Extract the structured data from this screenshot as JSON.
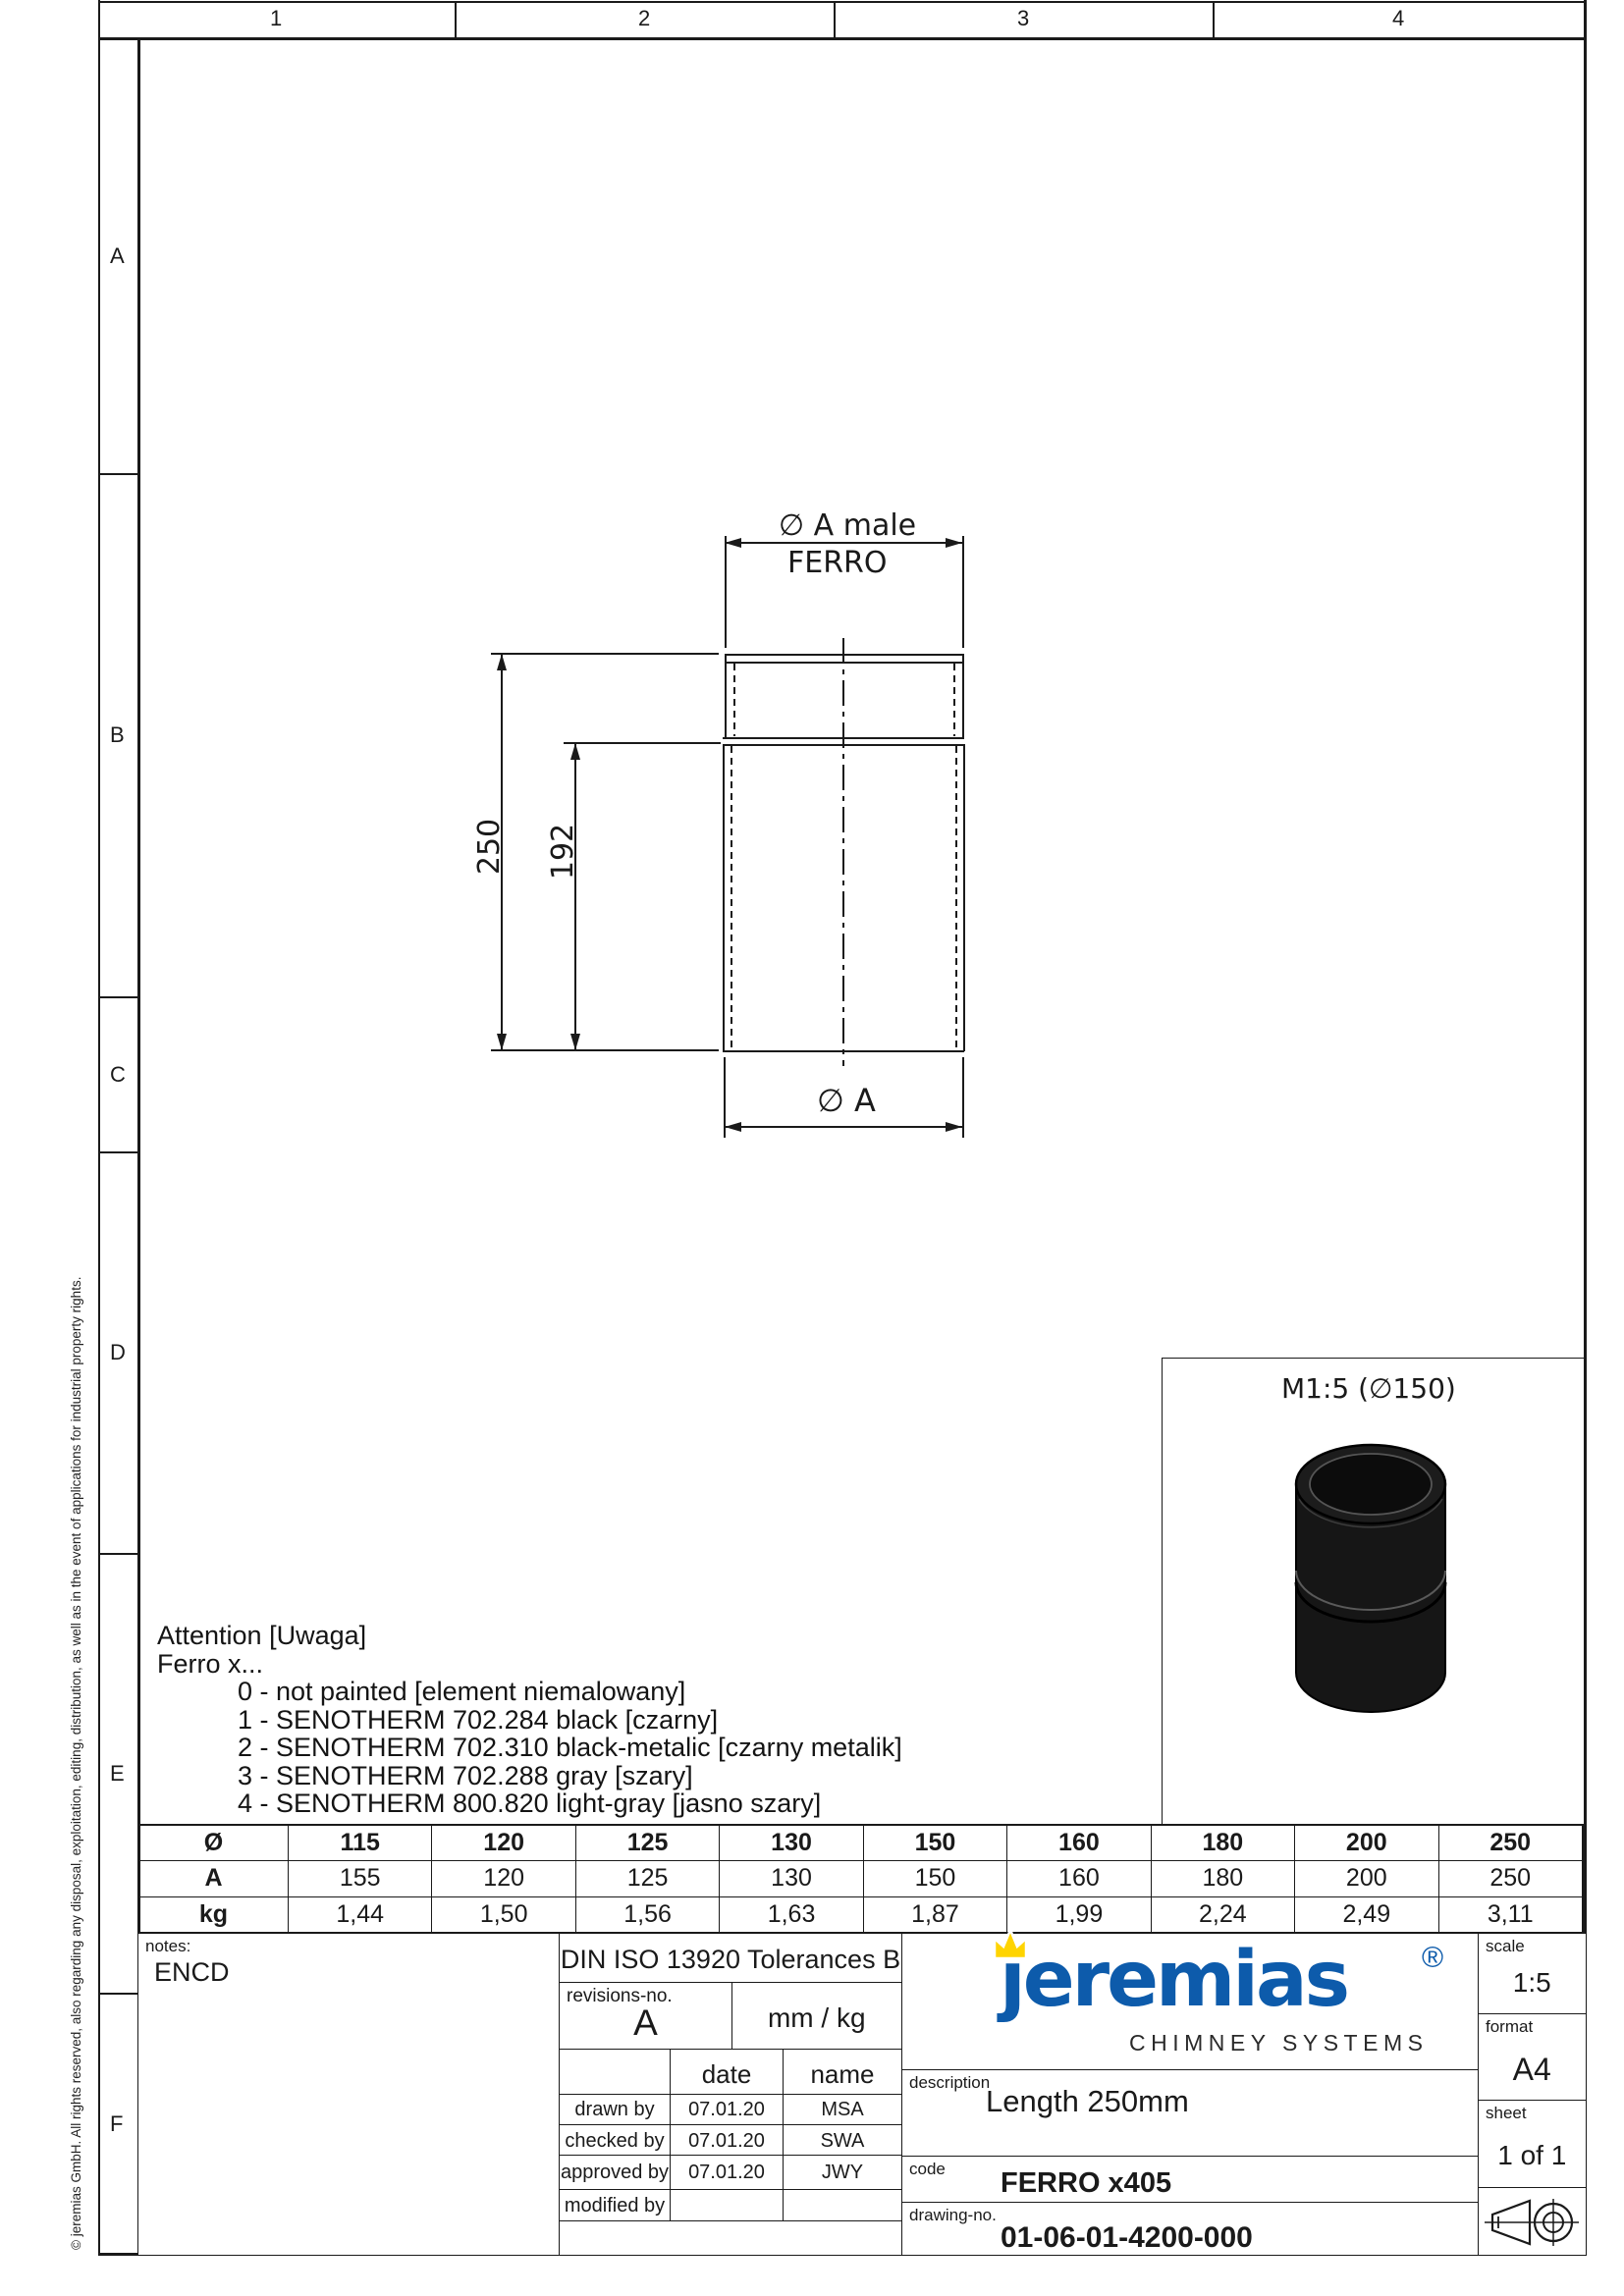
{
  "top_ruler": {
    "cells": [
      "1",
      "2",
      "3",
      "4"
    ]
  },
  "left_ruler": {
    "cells": [
      "A",
      "B",
      "C",
      "D",
      "E",
      "F"
    ]
  },
  "drawing": {
    "dim_top_label": "∅ A male",
    "dim_top_sublabel": "FERRO",
    "dim_bottom_label": "∅ A",
    "dim_height_outer": "250",
    "dim_height_inner": "192"
  },
  "detail_view": {
    "label": "M1:5 (∅150)"
  },
  "attention": {
    "line1": "Attention [Uwaga]",
    "line2": "Ferro x...",
    "items": [
      "0 - not painted [element niemalowany]",
      "1 - SENOTHERM 702.284 black [czarny]",
      "2 - SENOTHERM 702.310 black-metalic [czarny metalik]",
      "3 - SENOTHERM 702.288 gray [szary]",
      "4 - SENOTHERM 800.820 light-gray [jasno szary]"
    ]
  },
  "size_table": {
    "row_labels": [
      "Ø",
      "A",
      "kg"
    ],
    "diameters": [
      "115",
      "120",
      "125",
      "130",
      "150",
      "160",
      "180",
      "200",
      "250"
    ],
    "a_values": [
      "155",
      "120",
      "125",
      "130",
      "150",
      "160",
      "180",
      "200",
      "250"
    ],
    "kg_values": [
      "1,44",
      "1,50",
      "1,56",
      "1,63",
      "1,87",
      "1,99",
      "2,24",
      "2,49",
      "3,11"
    ]
  },
  "title_block": {
    "notes_label": "notes:",
    "notes_value": "ENCD",
    "tolerances": "DIN ISO 13920 Tolerances B",
    "revisions_label": "revisions-no.",
    "revision_value": "A",
    "units": "mm / kg",
    "date_header": "date",
    "name_header": "name",
    "rows": [
      {
        "label": "drawn by",
        "date": "07.01.20",
        "name": "MSA"
      },
      {
        "label": "checked by",
        "date": "07.01.20",
        "name": "SWA"
      },
      {
        "label": "approved by",
        "date": "07.01.20",
        "name": "JWY"
      },
      {
        "label": "modified by",
        "date": "",
        "name": ""
      }
    ],
    "description_label": "description",
    "description_value": "Length 250mm",
    "code_label": "code",
    "code_value": "FERRO x405",
    "drawing_no_label": "drawing-no.",
    "drawing_no_value": "01-06-01-4200-000",
    "scale_label": "scale",
    "scale_value": "1:5",
    "format_label": "format",
    "format_value": "A4",
    "sheet_label": "sheet",
    "sheet_value": "1 of 1"
  },
  "logo": {
    "wordmark": "jeremias",
    "registered": "®",
    "tagline": "CHIMNEY SYSTEMS",
    "blue": "#0d5bab",
    "yellow": "#ffd400"
  },
  "footer_note": "© jeremias GmbH. All rights reserved, also regarding any disposal, exploitation, editing, distribution, as well as in the event of applications for industrial property rights."
}
